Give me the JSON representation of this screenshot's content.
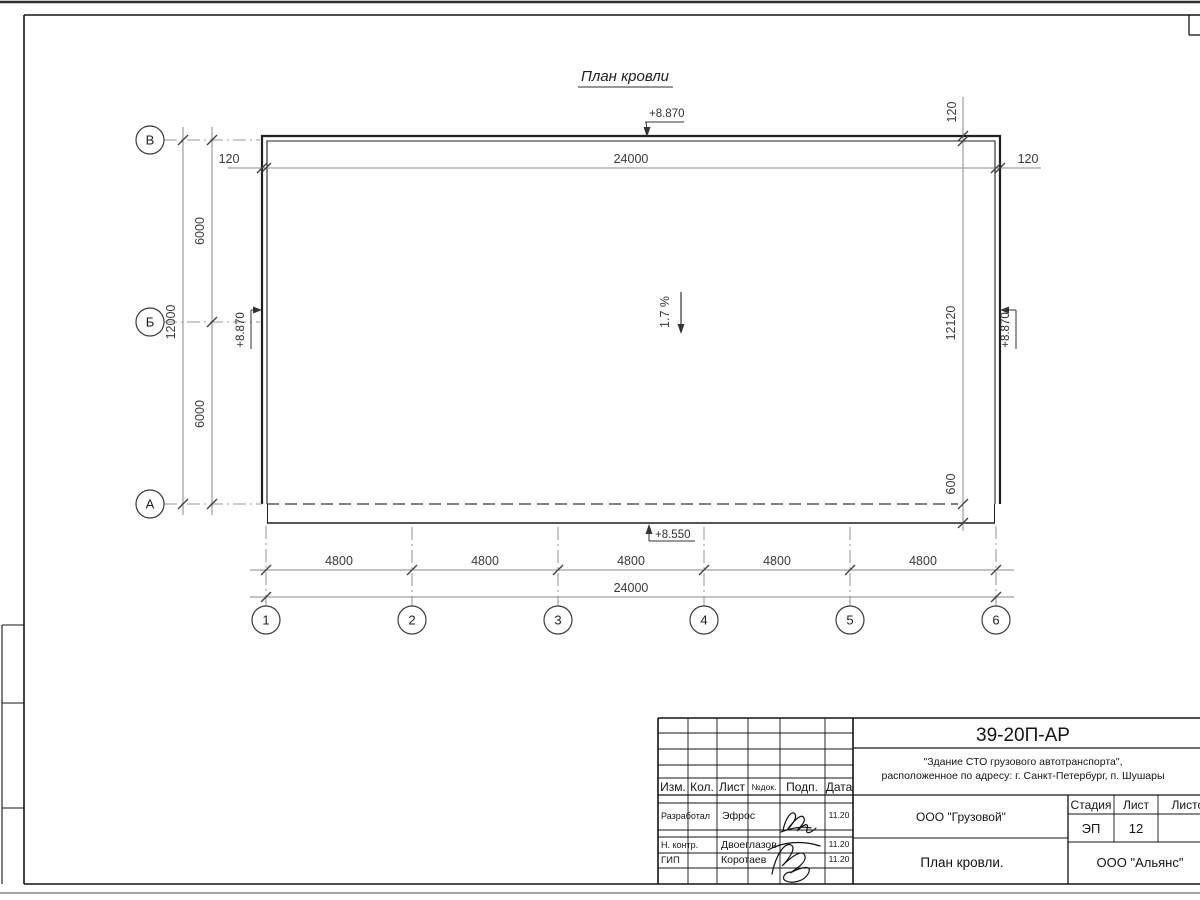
{
  "drawing": {
    "title": "План кровли",
    "slope_label": "1.7 %",
    "elev_top": "+8.870",
    "elev_left": "+8.870",
    "elev_right": "+8.870",
    "elev_bottom": "+8.550",
    "axis_rows": [
      "В",
      "Б",
      "А"
    ],
    "axis_cols": [
      "1",
      "2",
      "3",
      "4",
      "5",
      "6"
    ],
    "dim_top_left": "120",
    "dim_top_total": "24000",
    "dim_top_right": "120",
    "dim_left_seg1": "6000",
    "dim_left_seg2": "6000",
    "dim_left_total": "12000",
    "dim_right_top": "120",
    "dim_right_total": "12120",
    "dim_right_overhang": "600",
    "dim_bottom_segs": [
      "4800",
      "4800",
      "4800",
      "4800",
      "4800"
    ],
    "dim_bottom_total": "24000"
  },
  "title_block": {
    "doc_number": "39-20П-АР",
    "project_line1": "\"Здание СТО грузового автотранспорта\",",
    "project_line2": "расположенное по адресу: г. Санкт-Петербург, п. Шушары",
    "col_izm": "Изм.",
    "col_kol": "Кол.",
    "col_list": "Лист",
    "col_ndok": "№док.",
    "col_podp": "Подп.",
    "col_data": "Дата",
    "rows": [
      {
        "role": "Разработал",
        "name": "Эфрос",
        "date": "11.20"
      },
      {
        "role": "Н. контр.",
        "name": "Двоеглазов",
        "date": "11.20"
      },
      {
        "role": "ГИП",
        "name": "Коротаев",
        "date": "11.20"
      }
    ],
    "org_customer": "ООО \"Грузовой\"",
    "stage_label": "Стадия",
    "sheet_label": "Лист",
    "sheets_label": "Листов",
    "stage_value": "ЭП",
    "sheet_value": "12",
    "drawing_name": "План кровли.",
    "org_designer": "ООО \"Альянс\""
  }
}
